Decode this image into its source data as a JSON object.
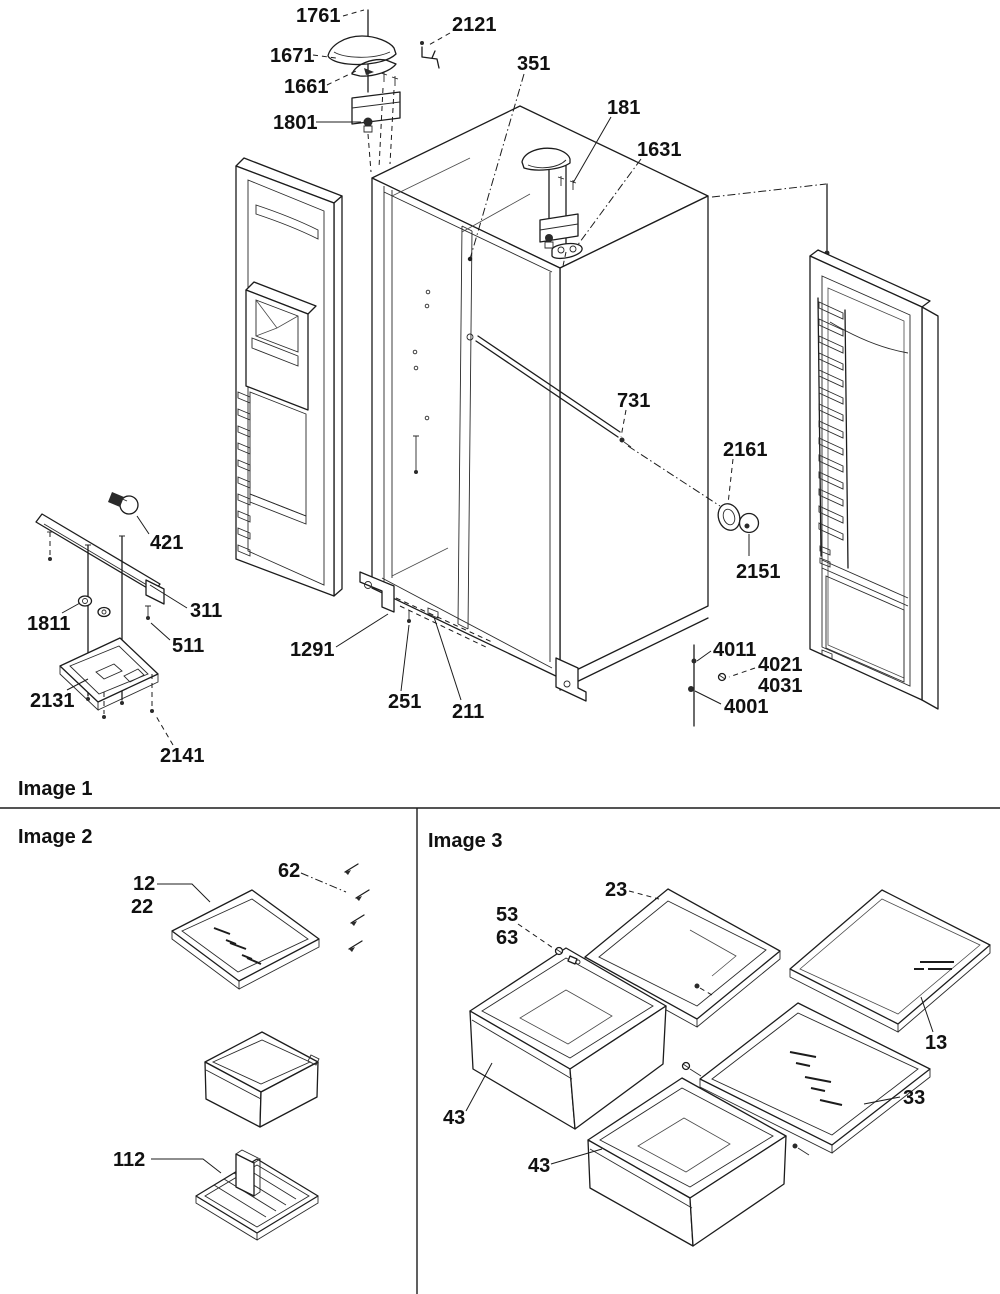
{
  "diagram": {
    "title": "Refrigerator exploded parts diagram",
    "background_color": "#ffffff",
    "line_color": "#1c1c1c",
    "dividers": {
      "horizontal_y": 808,
      "vertical_x": 417,
      "vertical_y1": 808,
      "vertical_y2": 1294
    },
    "sections": [
      {
        "label": "Image 1",
        "x": 18,
        "y": 795
      },
      {
        "label": "Image 2",
        "x": 18,
        "y": 843
      },
      {
        "label": "Image 3",
        "x": 428,
        "y": 847
      }
    ],
    "part_labels": [
      {
        "text": "1761",
        "x": 296,
        "y": 22,
        "style": "dashed",
        "leader": [
          [
            343,
            16
          ],
          [
            364,
            10
          ]
        ]
      },
      {
        "text": "2121",
        "x": 452,
        "y": 31,
        "style": "dashed",
        "leader": [
          [
            450,
            33
          ],
          [
            427,
            46
          ]
        ]
      },
      {
        "text": "1671",
        "x": 270,
        "y": 62,
        "style": "dashed",
        "leader": [
          [
            313,
            55
          ],
          [
            336,
            58
          ]
        ]
      },
      {
        "text": "1661",
        "x": 284,
        "y": 93,
        "style": "dashed",
        "leader": [
          [
            327,
            85
          ],
          [
            356,
            71
          ]
        ]
      },
      {
        "text": "1801",
        "x": 273,
        "y": 129,
        "style": "solid",
        "leader": [
          [
            316,
            122
          ],
          [
            361,
            122
          ]
        ]
      },
      {
        "text": "351",
        "x": 517,
        "y": 70,
        "style": "dashdot",
        "leader": [
          [
            524,
            74
          ],
          [
            470,
            259
          ]
        ],
        "end_dot": true
      },
      {
        "text": "181",
        "x": 607,
        "y": 114,
        "style": "solid",
        "leader": [
          [
            611,
            117
          ],
          [
            573,
            183
          ]
        ]
      },
      {
        "text": "1631",
        "x": 637,
        "y": 156,
        "style": "dashdot",
        "leader": [
          [
            641,
            159
          ],
          [
            577,
            246
          ]
        ]
      },
      {
        "text": "731",
        "x": 617,
        "y": 407,
        "style": "dashed",
        "leader": [
          [
            626,
            410
          ],
          [
            621,
            437
          ]
        ]
      },
      {
        "text": "2161",
        "x": 723,
        "y": 456,
        "style": "dashed",
        "leader": [
          [
            733,
            459
          ],
          [
            728,
            504
          ]
        ]
      },
      {
        "text": "2151",
        "x": 736,
        "y": 578,
        "style": "solid",
        "leader": [
          [
            749,
            556
          ],
          [
            749,
            534
          ]
        ]
      },
      {
        "text": "4011",
        "x": 713,
        "y": 656,
        "style": "solid",
        "leader": [
          [
            711,
            651
          ],
          [
            697,
            661
          ]
        ]
      },
      {
        "text": "4021",
        "x": 758,
        "y": 671,
        "style": "dashed",
        "leader": [
          [
            755,
            668
          ],
          [
            729,
            677
          ]
        ]
      },
      {
        "text": "4031",
        "x": 758,
        "y": 692,
        "style": "none"
      },
      {
        "text": "4001",
        "x": 724,
        "y": 713,
        "style": "solid",
        "leader": [
          [
            721,
            704
          ],
          [
            695,
            691
          ]
        ]
      },
      {
        "text": "421",
        "x": 150,
        "y": 549,
        "style": "solid",
        "leader": [
          [
            149,
            534
          ],
          [
            137,
            516
          ]
        ]
      },
      {
        "text": "311",
        "x": 190,
        "y": 617,
        "style": "solid",
        "leader": [
          [
            187,
            608
          ],
          [
            150,
            585
          ]
        ]
      },
      {
        "text": "1811",
        "x": 27,
        "y": 630,
        "style": "solid",
        "leader": [
          [
            62,
            613
          ],
          [
            80,
            603
          ]
        ]
      },
      {
        "text": "511",
        "x": 172,
        "y": 652,
        "style": "solid",
        "leader": [
          [
            170,
            640
          ],
          [
            151,
            623
          ]
        ]
      },
      {
        "text": "2131",
        "x": 30,
        "y": 707,
        "style": "solid",
        "leader": [
          [
            67,
            690
          ],
          [
            88,
            679
          ]
        ]
      },
      {
        "text": "2141",
        "x": 160,
        "y": 762,
        "style": "dashed",
        "leader": [
          [
            173,
            745
          ],
          [
            156,
            716
          ]
        ]
      },
      {
        "text": "1291",
        "x": 290,
        "y": 656,
        "style": "solid",
        "leader": [
          [
            336,
            647
          ],
          [
            388,
            614
          ]
        ]
      },
      {
        "text": "251",
        "x": 388,
        "y": 708,
        "style": "solid",
        "leader": [
          [
            401,
            691
          ],
          [
            409,
            625
          ]
        ]
      },
      {
        "text": "211",
        "x": 452,
        "y": 718,
        "style": "solid",
        "leader": [
          [
            461,
            700
          ],
          [
            434,
            617
          ]
        ]
      },
      {
        "text": "12",
        "x": 133,
        "y": 890,
        "style": "solid",
        "leader": [
          [
            157,
            884
          ],
          [
            192,
            884
          ],
          [
            210,
            902
          ]
        ]
      },
      {
        "text": "22",
        "x": 131,
        "y": 913,
        "style": "none"
      },
      {
        "text": "62",
        "x": 278,
        "y": 877,
        "style": "dashdot",
        "leader": [
          [
            301,
            873
          ],
          [
            346,
            892
          ]
        ]
      },
      {
        "text": "112",
        "x": 113,
        "y": 1166,
        "style": "solid",
        "leader": [
          [
            151,
            1159
          ],
          [
            203,
            1159
          ],
          [
            221,
            1173
          ]
        ]
      },
      {
        "text": "23",
        "x": 605,
        "y": 896,
        "style": "dashed",
        "leader": [
          [
            629,
            891
          ],
          [
            659,
            899
          ]
        ]
      },
      {
        "text": "53",
        "x": 496,
        "y": 921,
        "style": "dashed",
        "leader": [
          [
            518,
            924
          ],
          [
            556,
            950
          ]
        ]
      },
      {
        "text": "63",
        "x": 496,
        "y": 944,
        "style": "none"
      },
      {
        "text": "43",
        "x": 443,
        "y": 1124,
        "style": "solid",
        "leader": [
          [
            466,
            1111
          ],
          [
            492,
            1063
          ]
        ]
      },
      {
        "text": "43",
        "x": 528,
        "y": 1172,
        "style": "solid",
        "leader": [
          [
            551,
            1164
          ],
          [
            602,
            1149
          ]
        ]
      },
      {
        "text": "13",
        "x": 925,
        "y": 1049,
        "style": "solid",
        "leader": [
          [
            933,
            1032
          ],
          [
            921,
            997
          ]
        ]
      },
      {
        "text": "33",
        "x": 903,
        "y": 1104,
        "style": "solid",
        "leader": [
          [
            900,
            1097
          ],
          [
            864,
            1104
          ]
        ]
      }
    ]
  }
}
